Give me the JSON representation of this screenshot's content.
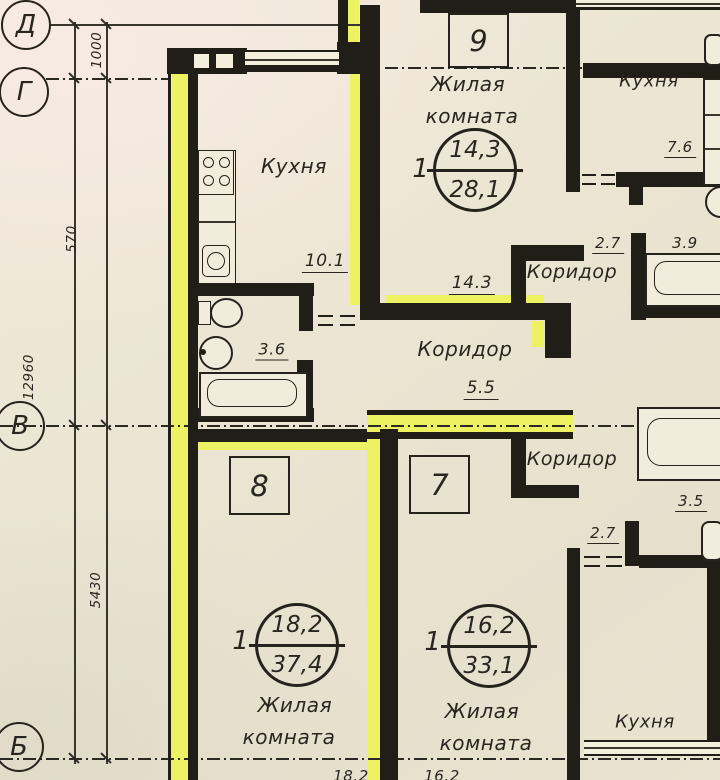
{
  "colors": {
    "paper": "#ece5d3",
    "ink": "#211e18",
    "highlight": "#edf262"
  },
  "axes": [
    {
      "label": "Д"
    },
    {
      "label": "Г"
    },
    {
      "label": "В"
    },
    {
      "label": "Б"
    }
  ],
  "dims": {
    "left_top": "1000",
    "left_mid": "570",
    "left_outer": "12960",
    "left_bottom": "5430",
    "bottom_1": "18.2",
    "bottom_2": "16.2"
  },
  "units": [
    {
      "number": "9"
    },
    {
      "number": "8"
    },
    {
      "number": "7"
    }
  ],
  "stamps": [
    {
      "rooms": "1",
      "living": "14,3",
      "total": "28,1"
    },
    {
      "rooms": "1",
      "living": "18,2",
      "total": "37,4"
    },
    {
      "rooms": "1",
      "living": "16,2",
      "total": "33,1"
    }
  ],
  "labels": {
    "kitchen_left": "Кухня",
    "kitchen_left_area": "10.1",
    "bathroom_area": "3.6",
    "living_top_1": "Жилая",
    "living_top_2": "комната",
    "living_top_dim": "14.3",
    "kitchen_right": "Кухня",
    "kitchen_right_area": "7.6",
    "corridor_top": "Коридор",
    "corridor_top_a": "2.7",
    "corridor_top_b": "3.9",
    "corridor_mid": "Коридор",
    "corridor_mid_area": "5.5",
    "corridor_low": "Коридор",
    "corridor_low_a": "3.5",
    "corridor_low_b": "2.7",
    "living_8_1": "Жилая",
    "living_8_2": "комната",
    "living_7_1": "Жилая",
    "living_7_2": "комната",
    "kitchen_bottom": "Кухня"
  }
}
